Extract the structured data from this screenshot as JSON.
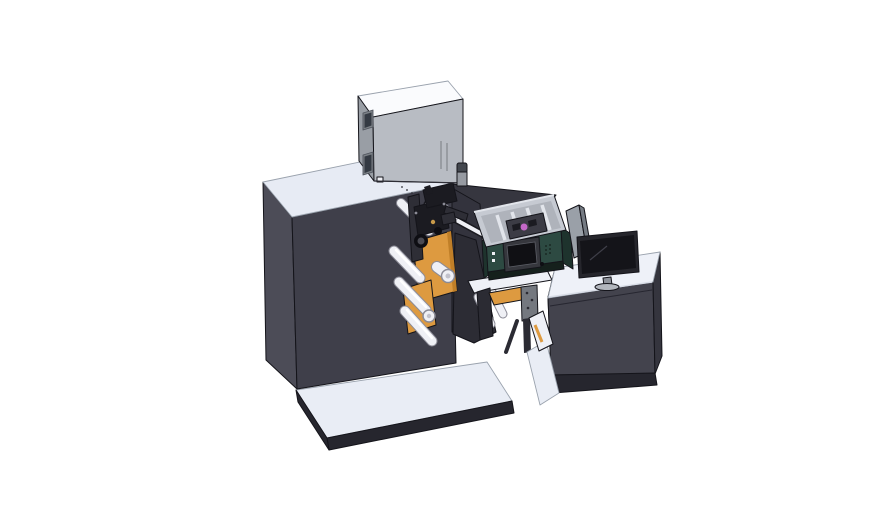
{
  "scene": {
    "type": "3d-cad-render",
    "background": "#ffffff",
    "parts": [
      "base-platform",
      "main-machine-body",
      "electrical-cabinet-box",
      "cabinet-windows",
      "exhaust-cylinder",
      "printhead-mechanism",
      "unwind-rollers",
      "orange-mount-plates",
      "rewind-plate",
      "web-guide-rail",
      "marking-unit",
      "marking-unit-display",
      "parts-tray",
      "tray-print-cartridge",
      "transfer-chute",
      "sensor-bracket",
      "operator-desk",
      "desk-base",
      "divider-panel",
      "monitor"
    ]
  },
  "colors": {
    "background": "#ffffff",
    "machine_front": "#3f3f4a",
    "machine_left": "#4c4c57",
    "machine_top": "#e7ebf4",
    "machine_top_edge": "#9aa0ab",
    "wing_dark": "#36363f",
    "inner_face": "#33333d",
    "plate_dark": "#2c2c34",
    "base_top": "#e9edf5",
    "base_side": "#26262e",
    "box_top": "#fafbfd",
    "box_left": "#999ea5",
    "box_front": "#b8bcc3",
    "box_detail": "#82868c",
    "window_frame": "#7b8086",
    "window_glass": "#343a43",
    "cylinder_body": "#979ba2",
    "cylinder_cap": "#43474e",
    "orange": "#dd9a40",
    "orange_shade": "#c07f28",
    "roller_fill": "#eff0f5",
    "roller_edge": "#8b8b96",
    "roller_core": "#c2c2cc",
    "highlight_white": "#ffffff",
    "mech_black": "#1b1b21",
    "mech_gray": "#2e2e36",
    "mech_hub": "#0e0e13",
    "hub_inner": "#4a4a52",
    "brass": "#c89a4a",
    "teal": "#2d4a42",
    "teal_side": "#1e332d",
    "teal_base": "#15201c",
    "display_frame": "#36373d",
    "display_screen": "#101014",
    "tray_wall": "#c6cad2",
    "tray_inner": "#afb3bb",
    "tray_rib": "#e2e5eb",
    "tray_mech": "#3c3c45",
    "magenta": "#c468c8",
    "panel_gray": "#9aa0a8",
    "panel_fold": "#757b83",
    "monitor_frame": "#26262c",
    "monitor_screen": "#141419",
    "monitor_stand": "#8e929a",
    "monitor_base": "#b2b6bd",
    "desk_front": "#43434d",
    "desk_left": "#4a4a55",
    "desk_right": "#35353e",
    "desk_top": "#eef1f8",
    "chute_white": "#eef0f6",
    "bracket_gray": "#74787f",
    "leg_dark": "#2b2b33",
    "edge_light": "#d9dde7",
    "reflection": "#3f3f49",
    "seam_dark": "#262630"
  }
}
